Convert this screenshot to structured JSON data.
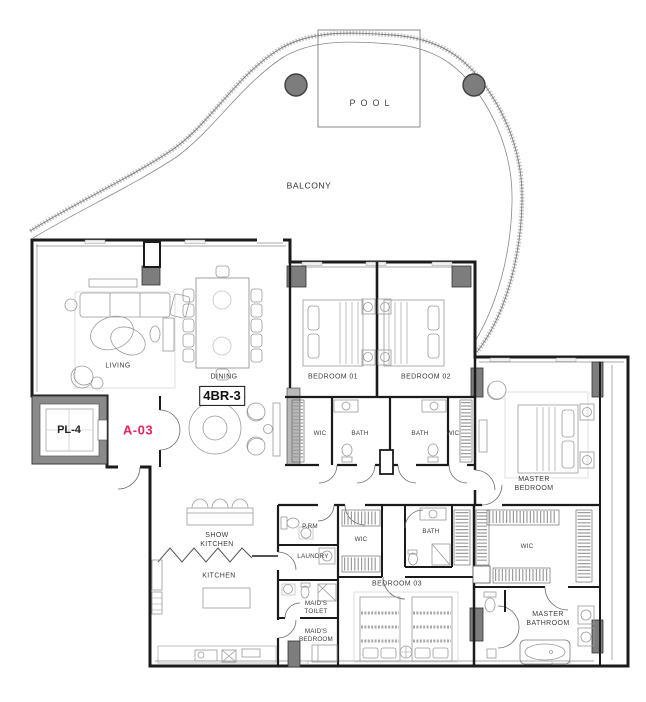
{
  "unit": {
    "type_label": "4BR-3",
    "number": "A-03",
    "elevator": "PL-4"
  },
  "colors": {
    "accent": "#e8255c",
    "column": "#7d7d7d",
    "wall": "#1b1b1b",
    "balcony_hatch": "#c3c3c3"
  },
  "labels": {
    "pool": "POOL",
    "balcony": "BALCONY",
    "living": "LIVING",
    "dining": "DINING",
    "bedroom_01": "BEDROOM 01",
    "bedroom_02": "BEDROOM 02",
    "bedroom_03": "BEDROOM 03",
    "master_bedroom": "MASTER BEDROOM",
    "wic": "WIC",
    "bath": "BATH",
    "show_kitchen": "SHOW KITCHEN",
    "kitchen": "KITCHEN",
    "powder_room": "P.RM",
    "laundry": "LAUNDRY",
    "maids_toilet": "MAID'S TOILET",
    "maids_bedroom": "MAID'S BEDROOM",
    "master_bathroom": "MASTER BATHROOM"
  }
}
